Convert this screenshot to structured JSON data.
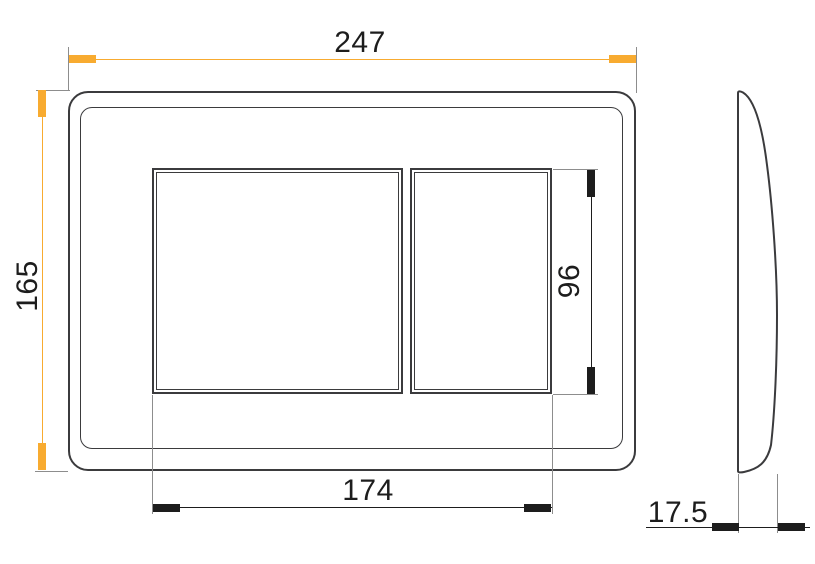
{
  "dimensions": {
    "overall_width": "247",
    "overall_height": "165",
    "buttons_overall_width": "174",
    "button_height": "96",
    "thickness": "17.5"
  },
  "style": {
    "accent_color": "#F8AB30",
    "outline_color": "#3B3B3D",
    "extension_line_color": "#8D8D8D",
    "text_color": "#1D1D1D",
    "background_color": "#FFFFFF"
  }
}
